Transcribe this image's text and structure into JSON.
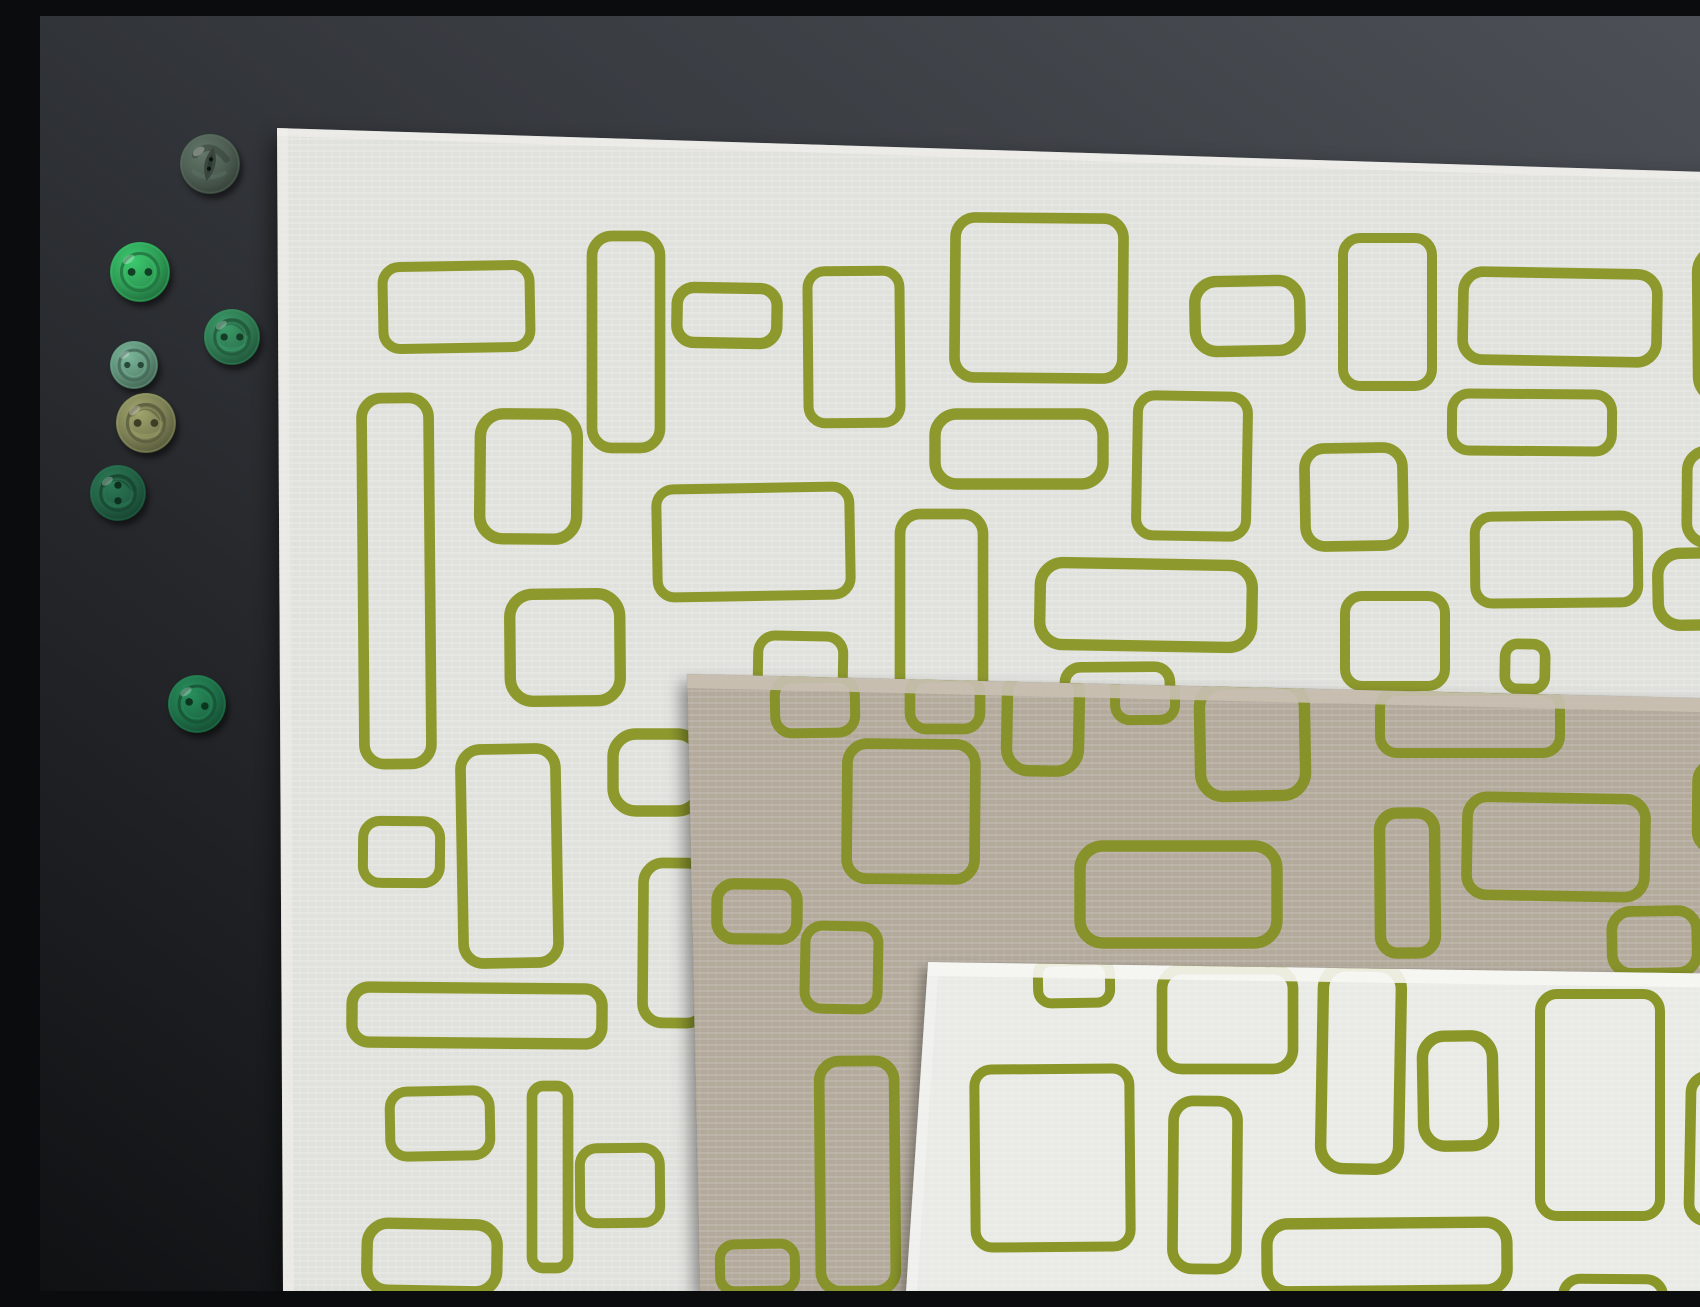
{
  "scene": {
    "width": 1700,
    "height": 1275,
    "description": "Flat-lay photograph: three linen fabric swatches screen-printed with hand-drawn olive-green rounded-rectangle outlines, layered diagonally on a dark charcoal background, with seven assorted green buttons arranged along the left side."
  },
  "palette": {
    "bg_top_right": "#4d5157",
    "bg_mid": "#34373c",
    "bg_bottom_left": "#101113",
    "print_green": "#8e992d"
  },
  "fabrics": [
    {
      "id": "white-linen-large",
      "label": "large white linen swatch (bottom layer)",
      "base": "#e0e1dd",
      "fold": "#f1f0ec",
      "green": "#8e992d",
      "texture_opacity": 0.5,
      "polygon": [
        [
          237,
          112
        ],
        [
          1700,
          157
        ],
        [
          1700,
          1275
        ],
        [
          243,
          1275
        ]
      ],
      "rects": [
        [
          343,
          250,
          147,
          82
        ],
        [
          552,
          220,
          68,
          212
        ],
        [
          637,
          272,
          100,
          55
        ],
        [
          768,
          255,
          92,
          152
        ],
        [
          915,
          202,
          168,
          160
        ],
        [
          1155,
          265,
          105,
          70
        ],
        [
          1303,
          222,
          89,
          148
        ],
        [
          1423,
          257,
          194,
          88
        ],
        [
          1658,
          233,
          80,
          150
        ],
        [
          1412,
          378,
          160,
          57
        ],
        [
          1265,
          432,
          98,
          98
        ],
        [
          895,
          398,
          168,
          70
        ],
        [
          1097,
          380,
          110,
          140
        ],
        [
          323,
          382,
          67,
          366
        ],
        [
          440,
          398,
          97,
          125
        ],
        [
          617,
          472,
          193,
          108
        ],
        [
          860,
          498,
          83,
          212
        ],
        [
          1000,
          548,
          212,
          82
        ],
        [
          1435,
          500,
          163,
          87
        ],
        [
          1647,
          435,
          75,
          92
        ],
        [
          1618,
          537,
          82,
          72
        ],
        [
          1305,
          580,
          100,
          90
        ],
        [
          1465,
          628,
          40,
          45
        ],
        [
          470,
          578,
          110,
          107
        ],
        [
          323,
          805,
          77,
          62
        ],
        [
          422,
          733,
          95,
          214
        ],
        [
          573,
          718,
          87,
          77
        ],
        [
          718,
          620,
          85,
          60
        ],
        [
          1025,
          651,
          105,
          50
        ],
        [
          312,
          972,
          250,
          55
        ],
        [
          350,
          1075,
          100,
          65
        ],
        [
          492,
          1070,
          36,
          182
        ],
        [
          327,
          1208,
          130,
          67
        ],
        [
          540,
          1132,
          80,
          75
        ],
        [
          603,
          847,
          64,
          160
        ]
      ]
    },
    {
      "id": "taupe-linen",
      "label": "taupe linen swatch (middle layer)",
      "base": "#b3aa9c",
      "fold": "#c9c0b2",
      "green": "#87922a",
      "texture_opacity": 0.35,
      "polygon": [
        [
          647,
          658
        ],
        [
          1700,
          683
        ],
        [
          1700,
          1275
        ],
        [
          660,
          1275
        ]
      ],
      "rects": [
        [
          735,
          662,
          80,
          55
        ],
        [
          870,
          661,
          70,
          52
        ],
        [
          967,
          655,
          72,
          100
        ],
        [
          1075,
          656,
          60,
          48
        ],
        [
          807,
          728,
          128,
          135
        ],
        [
          1160,
          668,
          105,
          112
        ],
        [
          1340,
          675,
          180,
          62
        ],
        [
          1427,
          782,
          178,
          98
        ],
        [
          1340,
          797,
          55,
          140
        ],
        [
          1657,
          748,
          70,
          85
        ],
        [
          1572,
          895,
          85,
          62
        ],
        [
          1040,
          830,
          197,
          97
        ],
        [
          765,
          910,
          73,
          83
        ],
        [
          780,
          1045,
          75,
          230
        ],
        [
          677,
          868,
          80,
          55
        ],
        [
          680,
          1228,
          75,
          47
        ]
      ]
    },
    {
      "id": "white-linen-small",
      "label": "small bright white linen swatch (top layer)",
      "base": "#e9eae6",
      "fold": "#f6f6f3",
      "green": "#8a9628",
      "texture_opacity": 0.4,
      "polygon": [
        [
          888,
          946
        ],
        [
          1700,
          958
        ],
        [
          1700,
          1275
        ],
        [
          866,
          1275
        ]
      ],
      "rects": [
        [
          998,
          945,
          72,
          42
        ],
        [
          1122,
          953,
          131,
          100
        ],
        [
          1282,
          950,
          78,
          203
        ],
        [
          935,
          1053,
          155,
          178
        ],
        [
          1133,
          1085,
          64,
          168
        ],
        [
          1383,
          1020,
          70,
          110
        ],
        [
          1500,
          978,
          120,
          222
        ],
        [
          1650,
          1060,
          55,
          145
        ],
        [
          1227,
          1207,
          240,
          68
        ],
        [
          1523,
          1263,
          100,
          60
        ]
      ]
    }
  ],
  "buttons": [
    {
      "name": "fisheye-dark-green-button",
      "cx": 170,
      "cy": 148,
      "r": 30,
      "base": "#4d5d52",
      "dark": "#2c3a31",
      "style": "fisheye",
      "hole_angle": 0,
      "marbled": true
    },
    {
      "name": "bright-green-button",
      "cx": 100,
      "cy": 256,
      "r": 30,
      "base": "#2f9e57",
      "dark": "#123f24",
      "style": "twohole",
      "hole_angle": 0,
      "marbled": false
    },
    {
      "name": "marbled-green-button",
      "cx": 192,
      "cy": 321,
      "r": 28,
      "base": "#2f7a52",
      "dark": "#143c27",
      "style": "twohole",
      "hole_angle": 0,
      "marbled": true
    },
    {
      "name": "sage-green-button",
      "cx": 94,
      "cy": 349,
      "r": 24,
      "base": "#5f8f78",
      "dark": "#27493a",
      "style": "twohole",
      "hole_angle": 0,
      "marbled": false
    },
    {
      "name": "olive-green-button",
      "cx": 106,
      "cy": 407,
      "r": 30,
      "base": "#7d8155",
      "dark": "#3c3f26",
      "style": "twohole",
      "hole_angle": 0,
      "marbled": true
    },
    {
      "name": "dark-marbled-green-button",
      "cx": 78,
      "cy": 477,
      "r": 28,
      "base": "#226044",
      "dark": "#0e2e1f",
      "style": "twohole",
      "hole_angle": 90,
      "marbled": true
    },
    {
      "name": "deep-green-ringed-button",
      "cx": 157,
      "cy": 688,
      "r": 29,
      "base": "#1f7049",
      "dark": "#0c3520",
      "style": "twohole",
      "hole_angle": 15,
      "marbled": false
    }
  ]
}
